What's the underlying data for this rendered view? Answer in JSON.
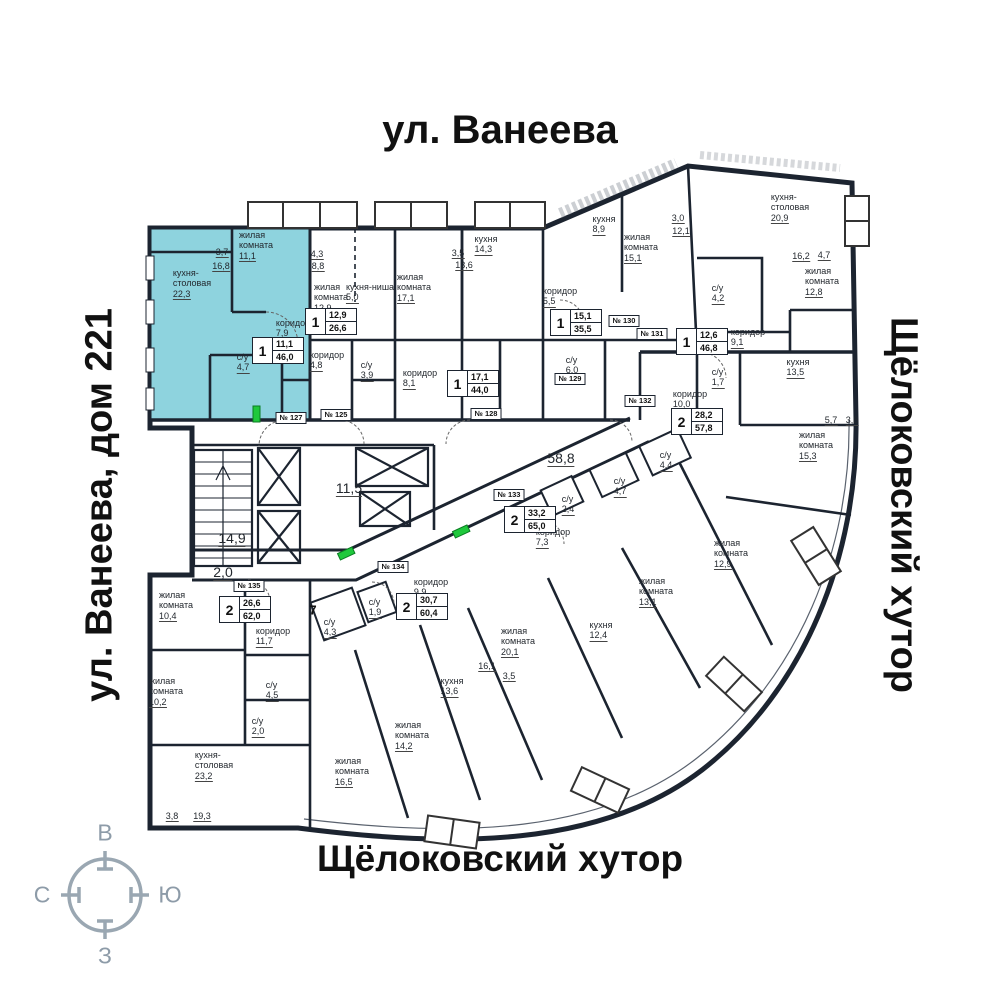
{
  "streets": {
    "top": "ул. Ванеева",
    "left": "ул. Ванеева, дом 221",
    "right": "Щёлоковский хутор",
    "bottom": "Щёлоковский хутор"
  },
  "compass": {
    "top": "В",
    "right": "Ю",
    "left": "С",
    "bottom": "З"
  },
  "floor_indicator": "7",
  "colors": {
    "highlight": "#8ed3de",
    "wall": "#1c2430",
    "door_marker_green": "#1fc83c",
    "compass_gray": "#9aa7b2"
  },
  "highlighted_apartment": {
    "badge": "1",
    "living_area": "11,1",
    "total_area": "46,0",
    "plate": "№ 127"
  },
  "badges": [
    {
      "t": "1",
      "living": "11,1",
      "total": "46,0",
      "x": 252,
      "y": 337,
      "highlight": true
    },
    {
      "t": "1",
      "living": "12,9",
      "total": "26,6",
      "x": 305,
      "y": 308,
      "highlight": false
    },
    {
      "t": "1",
      "living": "17,1",
      "total": "44,0",
      "x": 447,
      "y": 370,
      "highlight": false
    },
    {
      "t": "1",
      "living": "15,1",
      "total": "35,5",
      "x": 550,
      "y": 309,
      "highlight": false
    },
    {
      "t": "1",
      "living": "12,6",
      "total": "46,8",
      "x": 676,
      "y": 328,
      "highlight": false
    },
    {
      "t": "2",
      "living": "28,2",
      "total": "57,8",
      "x": 671,
      "y": 408,
      "highlight": false
    },
    {
      "t": "2",
      "living": "33,2",
      "total": "65,0",
      "x": 504,
      "y": 506,
      "highlight": false
    },
    {
      "t": "2",
      "living": "30,7",
      "total": "60,4",
      "x": 396,
      "y": 593,
      "highlight": false
    },
    {
      "t": "2",
      "living": "26,6",
      "total": "62,0",
      "x": 219,
      "y": 596,
      "highlight": false
    }
  ],
  "plates": [
    {
      "label": "№ 127",
      "x": 291,
      "y": 418
    },
    {
      "label": "№ 125",
      "x": 336,
      "y": 415
    },
    {
      "label": "№ 128",
      "x": 486,
      "y": 414
    },
    {
      "label": "№ 129",
      "x": 570,
      "y": 379
    },
    {
      "label": "№ 130",
      "x": 624,
      "y": 321
    },
    {
      "label": "№ 131",
      "x": 652,
      "y": 334
    },
    {
      "label": "№ 132",
      "x": 640,
      "y": 401
    },
    {
      "label": "№ 133",
      "x": 509,
      "y": 495
    },
    {
      "label": "№ 134",
      "x": 393,
      "y": 567
    },
    {
      "label": "№ 135",
      "x": 249,
      "y": 586
    }
  ],
  "rooms": [
    {
      "n": "кухня-\nстоловая",
      "a": "22,3",
      "x": 192,
      "y": 268
    },
    {
      "n": "жилая\nкомната",
      "a": "11,1",
      "x": 256,
      "y": 230
    },
    {
      "n": "коридор",
      "a": "7,9",
      "x": 293,
      "y": 318
    },
    {
      "n": "с/у",
      "a": "4,7",
      "x": 243,
      "y": 352
    },
    {
      "n": "жилая\nкомната",
      "a": "12,9",
      "x": 331,
      "y": 282
    },
    {
      "n": "кухня-ниша",
      "a": "5,0",
      "x": 370,
      "y": 282
    },
    {
      "n": "коридор",
      "a": "4,8",
      "x": 327,
      "y": 350
    },
    {
      "n": "с/у",
      "a": "3,9",
      "x": 367,
      "y": 360
    },
    {
      "n": "жилая\nкомната",
      "a": "17,1",
      "x": 414,
      "y": 272
    },
    {
      "n": "кухня",
      "a": "14,3",
      "x": 486,
      "y": 234
    },
    {
      "n": "коридор",
      "a": "8,1",
      "x": 420,
      "y": 368
    },
    {
      "n": "кухня",
      "a": "8,9",
      "x": 604,
      "y": 214
    },
    {
      "n": "жилая\nкомната",
      "a": "15,1",
      "x": 641,
      "y": 232
    },
    {
      "n": "коридор",
      "a": "5,5",
      "x": 560,
      "y": 286
    },
    {
      "n": "с/у",
      "a": "6,0",
      "x": 572,
      "y": 355
    },
    {
      "n": "кухня-\nстоловая",
      "a": "20,9",
      "x": 790,
      "y": 192
    },
    {
      "n": "жилая\nкомната",
      "a": "12,8",
      "x": 822,
      "y": 266
    },
    {
      "n": "с/у",
      "a": "4,2",
      "x": 718,
      "y": 283
    },
    {
      "n": "коридор",
      "a": "9,1",
      "x": 748,
      "y": 327
    },
    {
      "n": "с/у",
      "a": "1,7",
      "x": 718,
      "y": 367
    },
    {
      "n": "коридор",
      "a": "10,0",
      "x": 690,
      "y": 389
    },
    {
      "n": "кухня",
      "a": "13,5",
      "x": 798,
      "y": 357
    },
    {
      "n": "жилая\nкомната",
      "a": "15,3",
      "x": 816,
      "y": 430
    },
    {
      "n": "жилая\nкомната",
      "a": "12,9",
      "x": 731,
      "y": 538
    },
    {
      "n": "с/у",
      "a": "4,4",
      "x": 666,
      "y": 450
    },
    {
      "n": "с/у",
      "a": "4,7",
      "x": 620,
      "y": 476
    },
    {
      "n": "с/у",
      "a": "2,4",
      "x": 568,
      "y": 494
    },
    {
      "n": "коридор",
      "a": "7,3",
      "x": 553,
      "y": 527
    },
    {
      "n": "жилая\nкомната",
      "a": "13,1",
      "x": 656,
      "y": 576
    },
    {
      "n": "кухня",
      "a": "12,4",
      "x": 601,
      "y": 620
    },
    {
      "n": "жилая\nкомната",
      "a": "20,1",
      "x": 518,
      "y": 626
    },
    {
      "n": "коридор",
      "a": "9,9",
      "x": 431,
      "y": 577
    },
    {
      "n": "с/у",
      "a": "1,9",
      "x": 375,
      "y": 597
    },
    {
      "n": "с/у",
      "a": "4,3",
      "x": 330,
      "y": 617
    },
    {
      "n": "кухня",
      "a": "13,6",
      "x": 452,
      "y": 676
    },
    {
      "n": "жилая\nкомната",
      "a": "14,2",
      "x": 412,
      "y": 720
    },
    {
      "n": "жилая\nкомната",
      "a": "16,5",
      "x": 352,
      "y": 756
    },
    {
      "n": "жилая\nкомната",
      "a": "10,4",
      "x": 176,
      "y": 590
    },
    {
      "n": "жилая\nкомната",
      "a": "10,2",
      "x": 166,
      "y": 676
    },
    {
      "n": "коридор",
      "a": "11,7",
      "x": 273,
      "y": 626
    },
    {
      "n": "с/у",
      "a": "4,5",
      "x": 272,
      "y": 680
    },
    {
      "n": "с/у",
      "a": "2,0",
      "x": 258,
      "y": 716
    },
    {
      "n": "кухня-\nстоловая",
      "a": "23,2",
      "x": 214,
      "y": 750
    }
  ],
  "dims": [
    {
      "v": "3,7",
      "x": 222,
      "y": 247
    },
    {
      "v": "16,8",
      "x": 221,
      "y": 261
    },
    {
      "v": "4,3",
      "x": 317,
      "y": 249
    },
    {
      "v": "8,8",
      "x": 318,
      "y": 261
    },
    {
      "v": "3,5",
      "x": 458,
      "y": 248
    },
    {
      "v": "13,6",
      "x": 464,
      "y": 260
    },
    {
      "v": "3,0",
      "x": 678,
      "y": 213
    },
    {
      "v": "12,1",
      "x": 681,
      "y": 226
    },
    {
      "v": "16,2",
      "x": 801,
      "y": 251
    },
    {
      "v": "4,7",
      "x": 824,
      "y": 250
    },
    {
      "v": "5,7",
      "x": 831,
      "y": 415
    },
    {
      "v": "3,8",
      "x": 852,
      "y": 415
    },
    {
      "v": "16,1",
      "x": 487,
      "y": 661
    },
    {
      "v": "3,5",
      "x": 509,
      "y": 671
    },
    {
      "v": "3,8",
      "x": 172,
      "y": 811
    },
    {
      "v": "19,3",
      "x": 202,
      "y": 811
    },
    {
      "v": "14,9",
      "x": 232,
      "y": 530,
      "lg": true
    },
    {
      "v": "2,0",
      "x": 223,
      "y": 564,
      "lg": true
    },
    {
      "v": "11,5",
      "x": 349,
      "y": 480,
      "lg": true
    },
    {
      "v": "58,8",
      "x": 561,
      "y": 450,
      "lg": true
    }
  ]
}
